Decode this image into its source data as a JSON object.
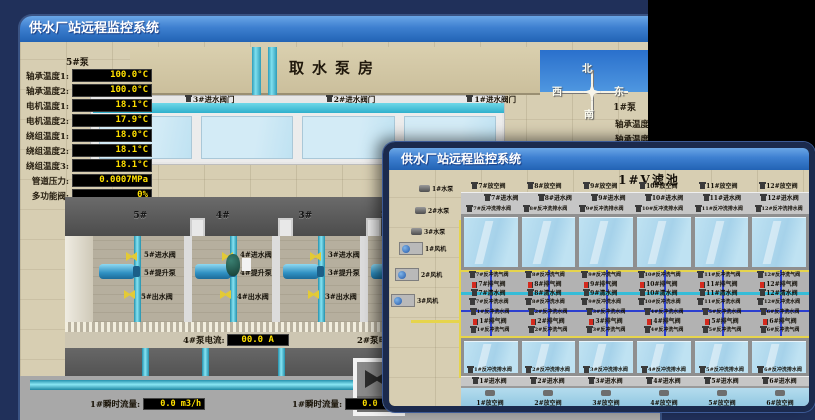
{
  "colors": {
    "desktop_bg": "#20305a",
    "backdrop": "#000000",
    "titlebar_top": "#6aa6e6",
    "titlebar_bottom": "#2263b4",
    "value_text": "#ffe000",
    "value_bg": "#000000",
    "pipe_cyan": "#35bcd8",
    "pipe_yellow": "#e6d44c",
    "alarm_red": "#d42a1e",
    "ground_tan": "#d7ceb2"
  },
  "back_window": {
    "title": "供水厂站远程监控系统",
    "building_sign": "取水泵房",
    "pump_tag": "5#泵",
    "readings": [
      {
        "label": "轴承温度1:",
        "value": "100.0°C"
      },
      {
        "label": "轴承温度2:",
        "value": "100.0°C"
      },
      {
        "label": "电机温度1:",
        "value": "18.1°C"
      },
      {
        "label": "电机温度2:",
        "value": "17.9°C"
      },
      {
        "label": "绕组温度1:",
        "value": "18.0°C"
      },
      {
        "label": "绕组温度2:",
        "value": "18.1°C"
      },
      {
        "label": "绕组温度3:",
        "value": "18.1°C"
      },
      {
        "label": "管道压力:",
        "value": "0.0007MPa"
      },
      {
        "label": "多功能阀:",
        "value": "0%"
      }
    ],
    "intake_valves": [
      "3#进水阀门",
      "2#进水阀门",
      "1#进水阀门"
    ],
    "compass": {
      "north": "北",
      "west": "西",
      "south": "南",
      "east": "东"
    },
    "right_pump_tag": "1#泵",
    "right_labels": [
      "轴承温度1:",
      "轴承温度2:"
    ],
    "bay_numbers": [
      "5#",
      "4#",
      "3#",
      "2#"
    ],
    "pump_units": [
      {
        "inlet": "5#进水阀",
        "pump": "5#提升泵",
        "outlet": "5#出水阀"
      },
      {
        "inlet": "4#进水阀",
        "pump": "4#提升泵",
        "outlet": "4#出水阀"
      },
      {
        "inlet": "3#进水阀",
        "pump": "3#提升泵",
        "outlet": "3#出水阀"
      }
    ],
    "current_left": {
      "label": "4#泵电流:",
      "value": "00.0 A"
    },
    "current_right_label": "2#泵电流:",
    "flow_left": {
      "label": "1#瞬时流量:",
      "value": "0.0 m3/h"
    },
    "flow_right": {
      "label": "1#瞬时流量:",
      "value": "0.0 m3/h"
    }
  },
  "front_window": {
    "title": "供水厂站远程监控系统",
    "scene_title": "1#V滤池",
    "water_pumps": [
      "1#水泵",
      "2#水泵",
      "3#水泵"
    ],
    "blowers": [
      "1#风机",
      "2#风机",
      "3#风机"
    ],
    "top_vent_valves": [
      "7#放空阀",
      "8#放空阀",
      "9#放空阀",
      "10#放空阀",
      "11#放空阀",
      "12#放空阀"
    ],
    "top_inlet_valves": [
      "7#进水阀",
      "8#进水阀",
      "9#进水阀",
      "10#进水阀",
      "11#进水阀",
      "12#进水阀"
    ],
    "top_drain_valves": [
      "7#反冲洗排水阀",
      "8#反冲洗排水阀",
      "9#反冲洗排水阀",
      "10#反冲洗排水阀",
      "11#反冲洗排水阀",
      "12#反冲洗排水阀"
    ],
    "mid_air_top": [
      "7#反冲洗气阀",
      "8#反冲洗气阀",
      "9#反冲洗气阀",
      "10#反冲洗气阀",
      "11#反冲洗气阀",
      "12#反冲洗气阀"
    ],
    "mid_exhaust_top": [
      "7#排气阀",
      "8#排气阀",
      "9#排气阀",
      "10#排气阀",
      "11#排气阀",
      "12#排气阀"
    ],
    "mid_clean_top": [
      "7#清水阀",
      "8#清水阀",
      "9#清水阀",
      "10#清水阀",
      "11#清水阀",
      "12#清水阀"
    ],
    "mid_wash_top": [
      "7#反冲洗水阀",
      "8#反冲洗水阀",
      "9#反冲洗水阀",
      "10#反冲洗水阀",
      "11#反冲洗水阀",
      "12#反冲洗水阀"
    ],
    "mid_wash_bottom": [
      "1#反冲洗水阀",
      "2#反冲洗水阀",
      "3#反冲洗水阀",
      "4#反冲洗水阀",
      "5#反冲洗水阀",
      "6#反冲洗水阀"
    ],
    "mid_exhaust_bottom": [
      "1#排气阀",
      "2#排气阀",
      "3#排气阀",
      "4#排气阀",
      "5#排气阀",
      "6#排气阀"
    ],
    "mid_air_bottom": [
      "1#反冲洗气阀",
      "2#反冲洗气阀",
      "3#反冲洗气阀",
      "4#反冲洗气阀",
      "5#反冲洗气阀",
      "6#反冲洗气阀"
    ],
    "bottom_drain_valves": [
      "1#反冲洗排水阀",
      "2#反冲洗排水阀",
      "3#反冲洗排水阀",
      "4#反冲洗排水阀",
      "5#反冲洗排水阀",
      "6#反冲洗排水阀"
    ],
    "bottom_inlet_valves": [
      "1#进水阀",
      "2#进水阀",
      "3#进水阀",
      "4#进水阀",
      "5#进水阀",
      "6#进水阀"
    ],
    "bottom_vent_valves": [
      "1#放空阀",
      "2#放空阀",
      "3#放空阀",
      "4#放空阀",
      "5#放空阀",
      "6#放空阀"
    ]
  }
}
